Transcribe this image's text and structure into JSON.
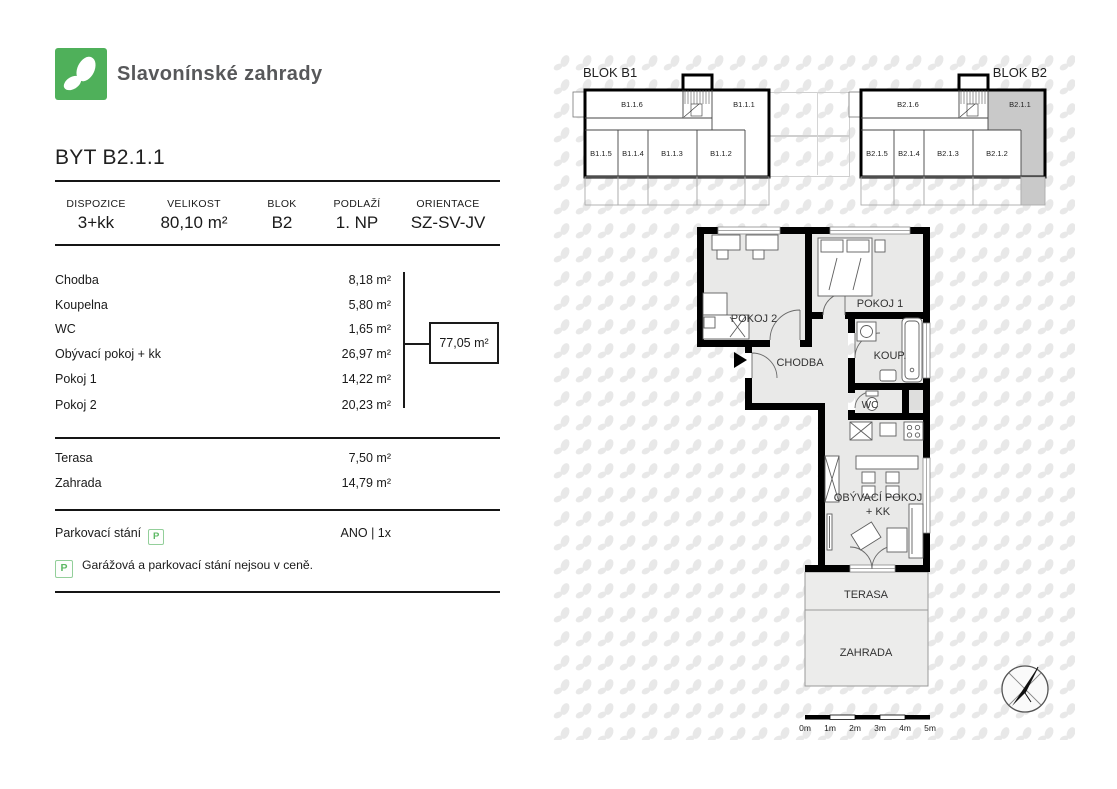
{
  "brand": {
    "name": "Slavonínské zahrady"
  },
  "apartment": {
    "title": "BYT B2.1.1"
  },
  "summary": {
    "columns": [
      {
        "label": "DISPOZICE",
        "value": "3+kk"
      },
      {
        "label": "VELIKOST",
        "value": "80,10 m²"
      },
      {
        "label": "BLOK",
        "value": "B2"
      },
      {
        "label": "PODLAŽÍ",
        "value": "1. NP"
      },
      {
        "label": "ORIENTACE",
        "value": "SZ-SV-JV"
      }
    ]
  },
  "rooms": [
    {
      "label": "Chodba",
      "area": "8,18 m²"
    },
    {
      "label": "Koupelna",
      "area": "5,80 m²"
    },
    {
      "label": "WC",
      "area": "1,65 m²"
    },
    {
      "label": "Obývací pokoj + kk",
      "area": "26,97 m²"
    },
    {
      "label": "Pokoj 1",
      "area": "14,22 m²"
    },
    {
      "label": "Pokoj 2",
      "area": "20,23 m²"
    }
  ],
  "interior_total": "77,05 m²",
  "outdoor": [
    {
      "label": "Terasa",
      "area": "7,50 m²"
    },
    {
      "label": "Zahrada",
      "area": "14,79 m²"
    }
  ],
  "parking": {
    "label": "Parkovací stání",
    "icon": "P",
    "value": "ANO | 1x"
  },
  "note": {
    "icon": "P",
    "text": "Garážová a parkovací stání nejsou v ceně."
  },
  "blocks": {
    "b1": {
      "title": "BLOK B1",
      "units": {
        "u6": "B1.1.6",
        "u1": "B1.1.1",
        "u5": "B1.1.5",
        "u4": "B1.1.4",
        "u3": "B1.1.3",
        "u2": "B1.1.2"
      }
    },
    "b2": {
      "title": "BLOK B2",
      "highlighted_unit": "B2.1.1",
      "units": {
        "u6": "B2.1.6",
        "u1": "B2.1.1",
        "u5": "B2.1.5",
        "u4": "B2.1.4",
        "u3": "B2.1.3",
        "u2": "B2.1.2"
      }
    }
  },
  "plan": {
    "labels": {
      "pokoj2": "POKOJ 2",
      "pokoj1": "POKOJ 1",
      "chodba": "CHODBA",
      "koupelna": "KOUP.",
      "wc": "WC",
      "obyvaci_line1": "OBÝVACÍ POKOJ",
      "obyvaci_line2": "+ KK",
      "terasa": "TERASA",
      "zahrada": "ZAHRADA"
    }
  },
  "scalebar": {
    "labels": [
      "0m",
      "1m",
      "2m",
      "3m",
      "4m",
      "5m"
    ]
  },
  "colors": {
    "brand_green": "#4fb05a",
    "highlight_gray": "#c9c9c9",
    "room_fill": "#e9e9e8",
    "leaf_gray": "#e8e8e8"
  }
}
